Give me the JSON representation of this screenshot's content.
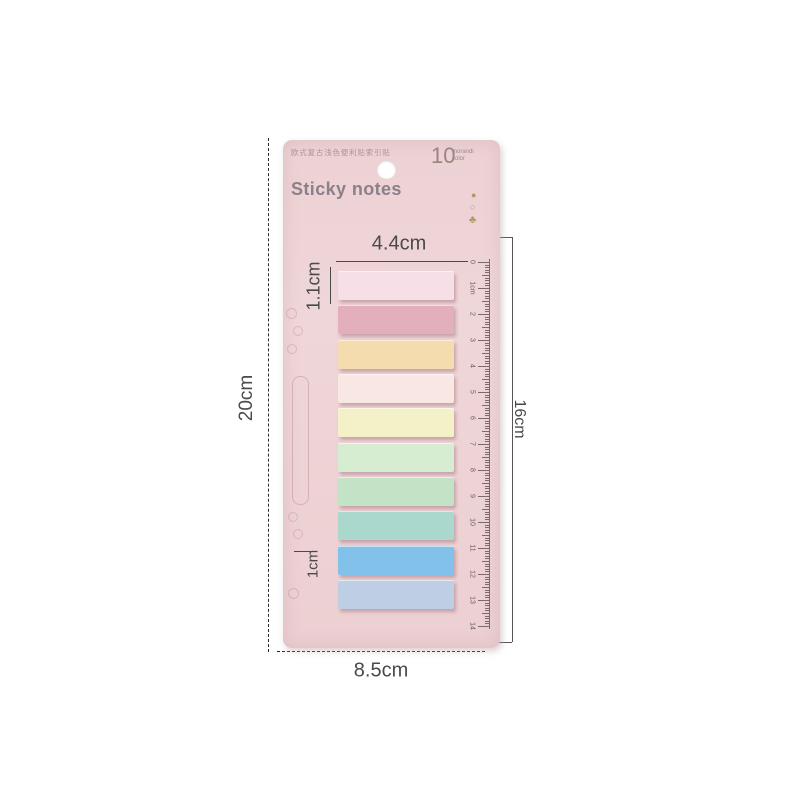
{
  "page": {
    "background": "#ffffff"
  },
  "card": {
    "title_cn": "欧式复古浅色便利贴索引贴",
    "title_en": "Sticky notes",
    "count": "10",
    "caption_line1": "morandi",
    "caption_line2": "color",
    "bg_color": "#eed4d6",
    "icons": [
      {
        "name": "gold-dot-icon",
        "glyph": "●"
      },
      {
        "name": "ring-icon",
        "glyph": "○"
      },
      {
        "name": "plant-icon",
        "glyph": "♣"
      }
    ]
  },
  "strips": [
    {
      "name": "light-pink",
      "color": "#f7dfe7"
    },
    {
      "name": "rose-pink",
      "color": "#e3afbc"
    },
    {
      "name": "peach",
      "color": "#f5dcae"
    },
    {
      "name": "blush",
      "color": "#f8e7e3"
    },
    {
      "name": "pale-yellow",
      "color": "#f4f1c9"
    },
    {
      "name": "mint",
      "color": "#d7edd2"
    },
    {
      "name": "green",
      "color": "#c2e3c6"
    },
    {
      "name": "seafoam",
      "color": "#abd8cc"
    },
    {
      "name": "sky-blue",
      "color": "#82c1e9"
    },
    {
      "name": "periwinkle",
      "color": "#becfe5"
    }
  ],
  "ruler": {
    "labels": [
      "0",
      "1cm",
      "2",
      "3",
      "4",
      "5",
      "6",
      "7",
      "8",
      "9",
      "10",
      "11",
      "12",
      "13",
      "14"
    ],
    "cm_count": 14,
    "color": "#6b5d5d"
  },
  "dimensions": {
    "top_width": "4.4cm",
    "strip_height": "1.1cm",
    "card_height": "20cm",
    "strips_span": "16cm",
    "card_width": "8.5cm",
    "bottom_gap": "1cm"
  }
}
